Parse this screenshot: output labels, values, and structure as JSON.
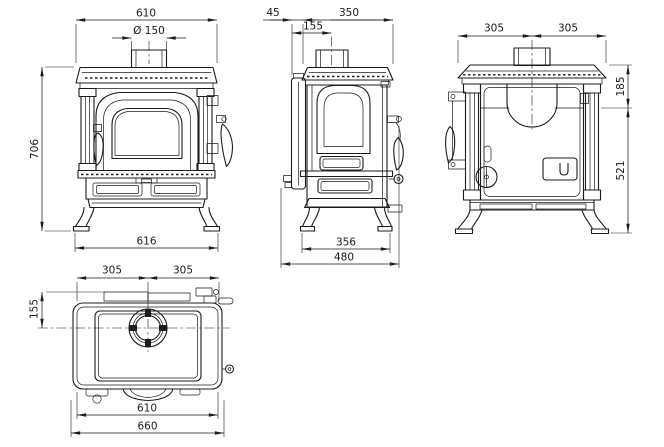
{
  "drawing": {
    "background": "#ffffff",
    "line_color": "#1c1c1c",
    "subject": "stove dimensional drawing",
    "views": {
      "front": {
        "name": "front-view",
        "dims": {
          "top_width": "610",
          "flue_diameter": "Ø 150",
          "overall_height": "706",
          "base_width": "616"
        }
      },
      "side": {
        "name": "side-view",
        "dims": {
          "door_offset": "45",
          "body_depth": "350",
          "flue_center_offset": "155",
          "leg_stance": "356",
          "overall_depth": "480"
        }
      },
      "rear": {
        "name": "rear-view",
        "dims": {
          "flue_left": "305",
          "flue_right": "305",
          "flue_drop": "185",
          "lower_height": "521"
        }
      },
      "top": {
        "name": "top-view",
        "dims": {
          "flue_left": "305",
          "flue_right": "305",
          "flue_depth": "155",
          "plate_width": "610",
          "overall_width": "660"
        }
      }
    }
  }
}
